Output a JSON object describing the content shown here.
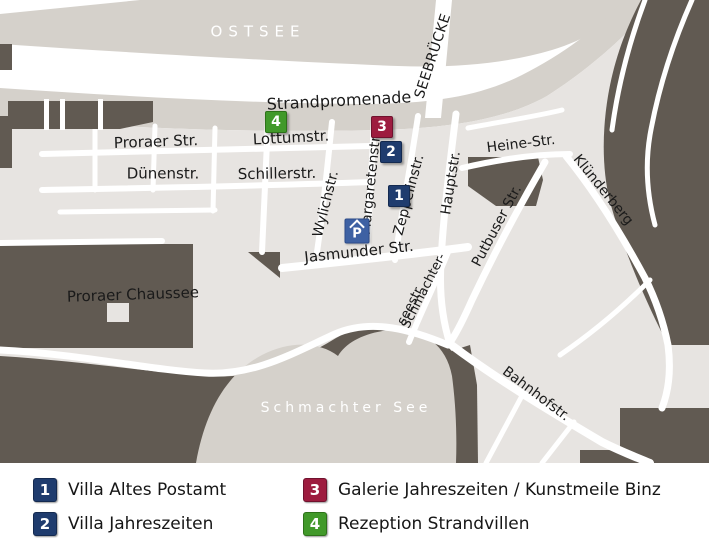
{
  "colors": {
    "sea": "#d5d1cb",
    "town": "#e7e4e1",
    "forest": "#615a52",
    "road": "#ffffff"
  },
  "map": {
    "labels": [
      {
        "id": "ostsee",
        "text": "OSTSEE",
        "x": 258,
        "y": 32,
        "rot": 0,
        "size": 15,
        "color": "#ffffff",
        "ls": 6
      },
      {
        "id": "seebruecke",
        "text": "SEEBRÜCKE",
        "x": 433,
        "y": 56,
        "rot": -72,
        "size": 14,
        "color": "#1a1a1a",
        "ls": 0.5
      },
      {
        "id": "strandpromenade",
        "text": "Strandpromenade",
        "x": 339,
        "y": 101,
        "rot": -3,
        "size": 16,
        "color": "#1a1a1a",
        "ls": 0
      },
      {
        "id": "proraer-str",
        "text": "Proraer Str.",
        "x": 156,
        "y": 142,
        "rot": -2,
        "size": 15,
        "color": "#1a1a1a",
        "ls": 0
      },
      {
        "id": "lottumstr",
        "text": "Lottumstr.",
        "x": 291,
        "y": 138,
        "rot": -3,
        "size": 15,
        "color": "#1a1a1a",
        "ls": 0
      },
      {
        "id": "duenenstr",
        "text": "Dünenstr.",
        "x": 163,
        "y": 174,
        "rot": 0,
        "size": 15,
        "color": "#1a1a1a",
        "ls": 0
      },
      {
        "id": "schillerstr",
        "text": "Schillerstr.",
        "x": 277,
        "y": 174,
        "rot": -1,
        "size": 15,
        "color": "#1a1a1a",
        "ls": 0
      },
      {
        "id": "wylichstr",
        "text": "Wylichstr.",
        "x": 326,
        "y": 204,
        "rot": -76,
        "size": 14,
        "color": "#1a1a1a",
        "ls": 0
      },
      {
        "id": "margaretenstr",
        "text": "Margaretenstr.",
        "x": 371,
        "y": 184,
        "rot": -84,
        "size": 14,
        "color": "#1a1a1a",
        "ls": 0
      },
      {
        "id": "zeppelinstr",
        "text": "Zeppelinstr.",
        "x": 409,
        "y": 195,
        "rot": -75,
        "size": 14,
        "color": "#1a1a1a",
        "ls": 0
      },
      {
        "id": "hauptstr",
        "text": "Hauptstr.",
        "x": 451,
        "y": 183,
        "rot": -81,
        "size": 14,
        "color": "#1a1a1a",
        "ls": 0
      },
      {
        "id": "heine-str",
        "text": "Heine-Str.",
        "x": 521,
        "y": 144,
        "rot": -7,
        "size": 14,
        "color": "#1a1a1a",
        "ls": 0
      },
      {
        "id": "kluenderberg",
        "text": "Klünderberg",
        "x": 603,
        "y": 190,
        "rot": 51,
        "size": 14,
        "color": "#1a1a1a",
        "ls": 0
      },
      {
        "id": "putbuser-str",
        "text": "Putbuser Str.",
        "x": 497,
        "y": 226,
        "rot": -62,
        "size": 14,
        "color": "#1a1a1a",
        "ls": 0
      },
      {
        "id": "jasmunder-str",
        "text": "Jasmunder Str.",
        "x": 359,
        "y": 252,
        "rot": -6,
        "size": 15,
        "color": "#1a1a1a",
        "ls": 0
      },
      {
        "id": "schmachterseestr-1",
        "text": "Schmachter-",
        "x": 424,
        "y": 291,
        "rot": -63,
        "size": 13,
        "color": "#1a1a1a",
        "ls": 0
      },
      {
        "id": "schmachterseestr-2",
        "text": "seestr.",
        "x": 411,
        "y": 305,
        "rot": -63,
        "size": 13,
        "color": "#1a1a1a",
        "ls": 0
      },
      {
        "id": "proraer-chaussee",
        "text": "Proraer Chaussee",
        "x": 133,
        "y": 295,
        "rot": -2,
        "size": 15,
        "color": "#1a1a1a",
        "ls": 0
      },
      {
        "id": "schmachter-see",
        "text": "Schmachter See",
        "x": 346,
        "y": 408,
        "rot": 0,
        "size": 14,
        "color": "#ffffff",
        "ls": 4
      },
      {
        "id": "bahnhofstr",
        "text": "Bahnhofstr.",
        "x": 536,
        "y": 394,
        "rot": 37,
        "size": 14,
        "color": "#1a1a1a",
        "ls": 0
      }
    ],
    "markers": [
      {
        "num": "1",
        "x": 399,
        "y": 196,
        "bg": "#1f3c6e",
        "border": "#142a50"
      },
      {
        "num": "2",
        "x": 391,
        "y": 152,
        "bg": "#1f3c6e",
        "border": "#142a50"
      },
      {
        "num": "3",
        "x": 382,
        "y": 127,
        "bg": "#9d1c3f",
        "border": "#70122e"
      },
      {
        "num": "4",
        "x": 276,
        "y": 122,
        "bg": "#41992a",
        "border": "#2d7219"
      }
    ],
    "parking": {
      "symbol": "P",
      "x": 357,
      "y": 231,
      "bg": "#3e61a3",
      "border": "#2d4c8a"
    }
  },
  "legend": {
    "items": [
      {
        "num": "1",
        "label": "Villa Altes Postamt",
        "bg": "#1f3c6e",
        "border": "#142a50",
        "x": 33,
        "y": 478
      },
      {
        "num": "2",
        "label": "Villa Jahreszeiten",
        "bg": "#1f3c6e",
        "border": "#142a50",
        "x": 33,
        "y": 512
      },
      {
        "num": "3",
        "label": "Galerie Jahreszeiten / Kunstmeile Binz",
        "bg": "#9d1c3f",
        "border": "#70122e",
        "x": 303,
        "y": 478
      },
      {
        "num": "4",
        "label": "Rezeption Strandvillen",
        "bg": "#41992a",
        "border": "#2d7219",
        "x": 303,
        "y": 512
      }
    ]
  }
}
